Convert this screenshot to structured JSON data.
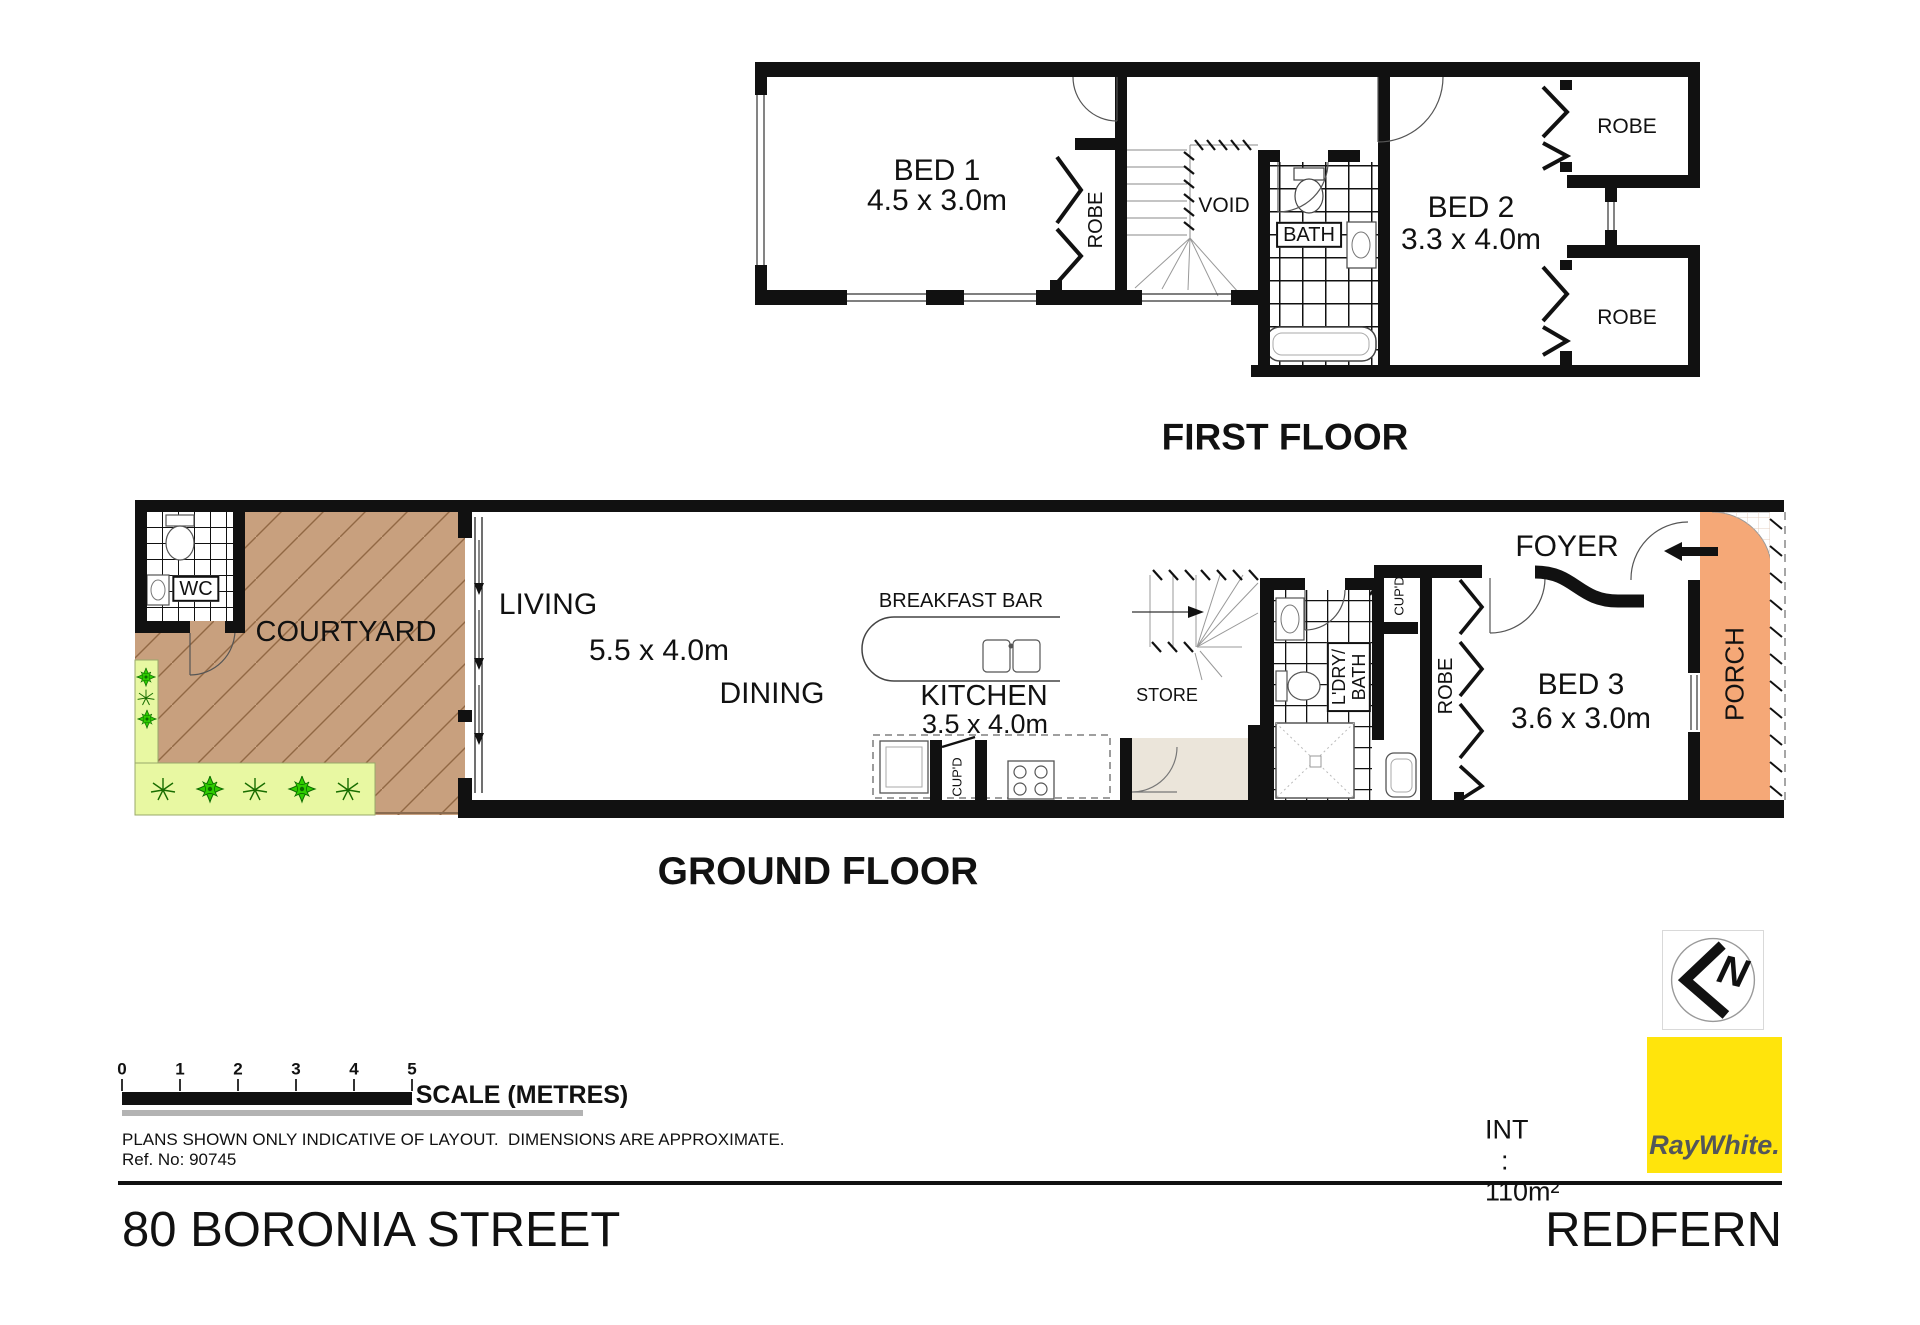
{
  "first_floor": {
    "title": "FIRST FLOOR",
    "bed1": "BED 1",
    "bed1_dims": "4.5 x 3.0m",
    "robe": "ROBE",
    "void": "VOID",
    "bath": "BATH",
    "bed2": "BED 2",
    "bed2_dims": "3.3 x 4.0m",
    "robe_top": "ROBE",
    "robe_bottom": "ROBE"
  },
  "ground_floor": {
    "title": "GROUND FLOOR",
    "wc": "WC",
    "courtyard": "COURTYARD",
    "living": "LIVING",
    "living_dims": "5.5 x 4.0m",
    "dining": "DINING",
    "breakfast_bar": "BREAKFAST BAR",
    "kitchen": "KITCHEN",
    "kitchen_dims": "3.5 x 4.0m",
    "store": "STORE",
    "cupd_kitchen": "CUP'D",
    "laundry_line1": "L'DRY/",
    "laundry_line2": "BATH",
    "cupd_hall": "CUP'D",
    "robe": "ROBE",
    "bed3": "BED 3",
    "bed3_dims": "3.6 x 3.0m",
    "foyer": "FOYER",
    "porch": "PORCH"
  },
  "scale_bar": {
    "ticks": [
      "0",
      "1",
      "2",
      "3",
      "4",
      "5"
    ],
    "label": "SCALE (METRES)"
  },
  "notes": {
    "disclaimer": "PLANS SHOWN ONLY INDICATIVE OF LAYOUT.  DIMENSIONS ARE APPROXIMATE.",
    "ref": "Ref. No: 90745"
  },
  "area": {
    "label": "INT",
    "sep": ":",
    "value": "110m²"
  },
  "footer": {
    "street": "80 BORONIA STREET",
    "suburb": "REDFERN"
  },
  "brand": {
    "wordmark": "RayWhite."
  },
  "compass": {
    "letter": "N"
  },
  "colors": {
    "courtyard": "#C8A07E",
    "garden": "#E8F8A2",
    "porch": "#F5A877",
    "nook": "#EBE5DA",
    "brand_yellow": "#FFE40C"
  }
}
